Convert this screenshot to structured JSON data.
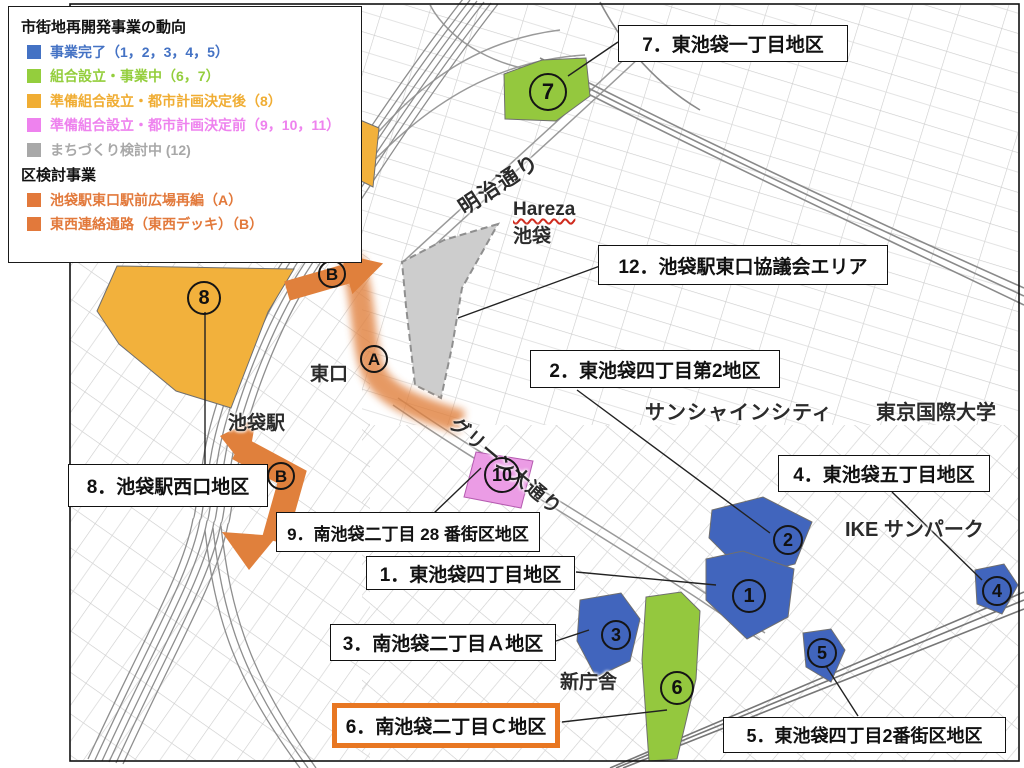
{
  "legend": {
    "title": "市街地再開発事業の動向",
    "items": [
      {
        "label": "事業完了（1，2，3，4，5）",
        "color": "#4472c4"
      },
      {
        "label": "組合設立・事業中（6，7）",
        "color": "#94ce3d"
      },
      {
        "label": "準備組合設立・都市計画決定後（8）",
        "color": "#f0ad33"
      },
      {
        "label": "準備組合設立・都市計画決定前（9，10，11）",
        "color": "#ee82ee"
      },
      {
        "label": "まちづくり検討中 (12)",
        "color": "#a8a8a8"
      }
    ],
    "subtitle": "区検討事業",
    "sub_items": [
      {
        "label": "池袋駅東口駅前広場再編（A）",
        "color": "#e2793b"
      },
      {
        "label": "東西連絡通路（東西デッキ）（B）",
        "color": "#e2793b"
      }
    ]
  },
  "map": {
    "colors": {
      "completed_blue": "#4165bd",
      "association_green": "#94c83e",
      "prep_after_orange": "#f2b13c",
      "prep_before_pink": "#eb9ce5",
      "study_gray": "#cdcdcd",
      "deck_orange": "#e0803c",
      "highlight_border": "#e87722"
    },
    "callouts": [
      {
        "text": "7．東池袋一丁目地区"
      },
      {
        "text": "12．池袋駅東口協議会エリア"
      },
      {
        "text": "2．東池袋四丁目第2地区"
      },
      {
        "text": "4．東池袋五丁目地区"
      },
      {
        "text": "8．池袋駅西口地区"
      },
      {
        "text": "9．南池袋二丁目 28 番街区地区"
      },
      {
        "text": "1．東池袋四丁目地区"
      },
      {
        "text": "3．南池袋二丁目Ａ地区"
      },
      {
        "text": "6．南池袋二丁目Ｃ地区"
      },
      {
        "text": "5．東池袋四丁目2番街区地区"
      }
    ],
    "places": [
      {
        "text": "明治通り"
      },
      {
        "text": "Hareza"
      },
      {
        "text": "池袋"
      },
      {
        "text": "東口"
      },
      {
        "text": "池袋駅"
      },
      {
        "text": "サンシャインシティ"
      },
      {
        "text": "東京国際大学"
      },
      {
        "text": "IKE サンパーク"
      },
      {
        "text": "グリーン大通り"
      },
      {
        "text": "新庁舎"
      }
    ],
    "markers": [
      {
        "glyph": "7"
      },
      {
        "glyph": "8"
      },
      {
        "glyph": "B"
      },
      {
        "glyph": "A"
      },
      {
        "glyph": "B"
      },
      {
        "glyph": "10"
      },
      {
        "glyph": "2"
      },
      {
        "glyph": "1"
      },
      {
        "glyph": "4"
      },
      {
        "glyph": "5"
      },
      {
        "glyph": "3"
      },
      {
        "glyph": "6"
      }
    ]
  }
}
